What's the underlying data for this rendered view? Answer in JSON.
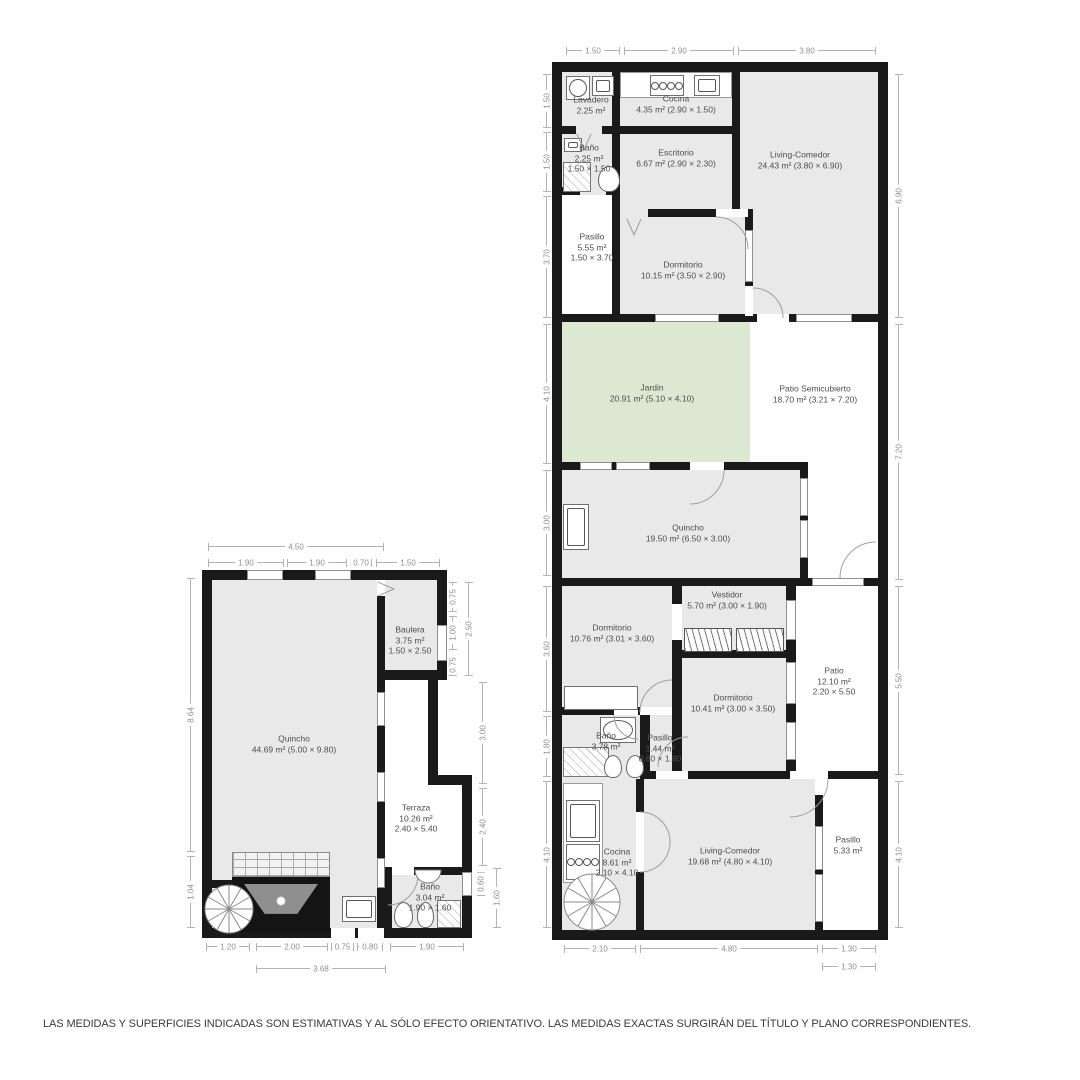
{
  "disclaimer": "LAS MEDIDAS Y SUPERFICIES INDICADAS SON ESTIMATIVAS Y AL SÓLO EFECTO ORIENTATIVO. LAS MEDIDAS EXACTAS SURGIRÁN DEL TÍTULO Y PLANO CORRESPONDIENTES.",
  "colors": {
    "wall": "#1a1a1a",
    "room_fill": "#e9e9e9",
    "garden_fill": "#dce8d2",
    "dim_line": "#b3b3b3",
    "label_text": "#4d4d4d"
  },
  "plans": {
    "main": {
      "rooms": {
        "lavadero": {
          "l1": "Lavadero",
          "l2": "2.25 m²"
        },
        "cocina_top": {
          "l1": "Cocina",
          "l2": "4.35 m² (2.90 × 1.50)"
        },
        "living_top": {
          "l1": "Living-Comedor",
          "l2": "24.43 m² (3.80 × 6.90)"
        },
        "bano_top": {
          "l1": "Baño",
          "l2": "2.25 m²",
          "l3": "1.50 × 1.50"
        },
        "escritorio": {
          "l1": "Escritorio",
          "l2": "6.67 m² (2.90 × 2.30)"
        },
        "pasillo_top": {
          "l1": "Pasillo",
          "l2": "5.55 m²",
          "l3": "1.50 × 3.70"
        },
        "dormitorio1": {
          "l1": "Dormitorio",
          "l2": "10.15 m² (3.50 × 2.90)"
        },
        "jardin": {
          "l1": "Jardin",
          "l2": "20.91 m² (5.10 × 4.10)"
        },
        "patio_semi": {
          "l1": "Patio Semicubierto",
          "l2": "18.70 m² (3.21 × 7.20)"
        },
        "quincho": {
          "l1": "Quincho",
          "l2": "19.50 m² (6.50 × 3.00)"
        },
        "dormitorio2": {
          "l1": "Dormitorio",
          "l2": "10.76 m² (3.01 × 3.60)"
        },
        "vestidor": {
          "l1": "Vestidor",
          "l2": "5.70 m² (3.00 × 1.90)"
        },
        "dormitorio3": {
          "l1": "Dormitorio",
          "l2": "10.41 m² (3.00 × 3.50)"
        },
        "patio": {
          "l1": "Patio",
          "l2": "12.10 m²",
          "l3": "2.20 × 5.50"
        },
        "bano_mid": {
          "l1": "Baño",
          "l2": "3.78 m²"
        },
        "pasillo_mid": {
          "l1": "Pasillo",
          "l2": "1.44 m²",
          "l3": "0.80 × 1.80"
        },
        "cocina_bottom": {
          "l1": "Cocina",
          "l2": "8.61 m²",
          "l3": "2.10 × 4.10"
        },
        "living_bottom": {
          "l1": "Living-Comedor",
          "l2": "19.68 m² (4.80 × 4.10)"
        },
        "pasillo_bottom": {
          "l1": "Pasillo",
          "l2": "5.33 m²"
        }
      },
      "dims": {
        "top": [
          "1.50",
          "2.90",
          "3.80"
        ],
        "left": [
          "1.50",
          "1.50",
          "3.70",
          "4.10",
          "3.00",
          "3.60",
          "1.80",
          "4.10"
        ],
        "right": [
          "6.90",
          "7.20",
          "5.50",
          "4.10"
        ],
        "bottom": [
          "2.10",
          "4.80",
          "1.30"
        ],
        "bottom2": [
          "1.30"
        ]
      }
    },
    "annex": {
      "rooms": {
        "quincho": {
          "l1": "Quincho",
          "l2": "44.69 m² (5.00 × 9.80)"
        },
        "baulera": {
          "l1": "Baulera",
          "l2": "3.75 m²",
          "l3": "1.50 × 2.50"
        },
        "terraza": {
          "l1": "Terraza",
          "l2": "10.26 m²",
          "l3": "2.40 × 5.40"
        },
        "bano": {
          "l1": "Baño",
          "l2": "3.04 m²",
          "l3": "1.90 × 1.60"
        }
      },
      "dims": {
        "top_overall": "4.50",
        "top": [
          "1.90",
          "1.90",
          "0.70",
          "1.50"
        ],
        "left": [
          "8.64",
          "1.04"
        ],
        "right": [
          "0.75",
          "1.00",
          "0.75",
          "2.50",
          "3.00",
          "2.40",
          "0.60",
          "1.60"
        ],
        "bottom": [
          "1.20",
          "2.00",
          "0.75",
          "0.80",
          "1.90"
        ],
        "bottom2": [
          "3.68"
        ]
      }
    }
  }
}
